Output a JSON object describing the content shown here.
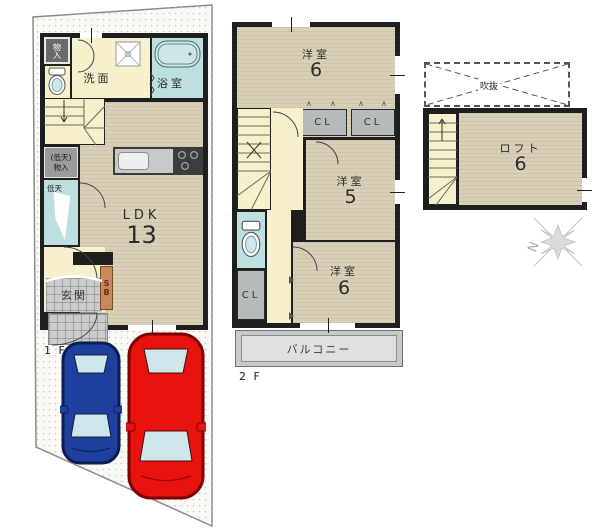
{
  "floors": {
    "f1": {
      "label": "1 F",
      "storage_top": "物入",
      "washroom": "洗面",
      "bathroom": "浴室",
      "lowceil_storage_l1": "(低天)",
      "lowceil_storage_l2": "物入",
      "lowceil": "低天",
      "ldk_name": "LDK",
      "ldk_size": "13",
      "shoebox": "SB",
      "entrance": "玄関"
    },
    "f2": {
      "label": "2 F",
      "bedroom_top_name": "洋室",
      "bedroom_top_size": "6",
      "closet_a": "CL",
      "closet_b": "CL",
      "bedroom_mid_name": "洋室",
      "bedroom_mid_size": "5",
      "closet_c": "CL",
      "bedroom_bottom_name": "洋室",
      "bedroom_bottom_size": "6",
      "balcony": "バルコニー"
    },
    "loft": {
      "void": "吹抜",
      "name": "ロフト",
      "size": "6"
    }
  },
  "compass": {
    "north": "N"
  },
  "colors": {
    "wall": "#1f1f1f",
    "floor_beige": "#d8cfb6",
    "hall_cream": "#f6f0cd",
    "wet_blue": "#bedfe0",
    "closet_gray": "#b7baba",
    "shoebox_brown": "#c9885c",
    "tile_gray": "#cbcbcb",
    "balcony_gray": "#dcdcdc",
    "car_blue": "#1e3f9e",
    "car_blue_dark": "#0a1d50",
    "car_red": "#e8120e",
    "car_red_dark": "#7e0403",
    "glass": "#cfe6ea"
  }
}
